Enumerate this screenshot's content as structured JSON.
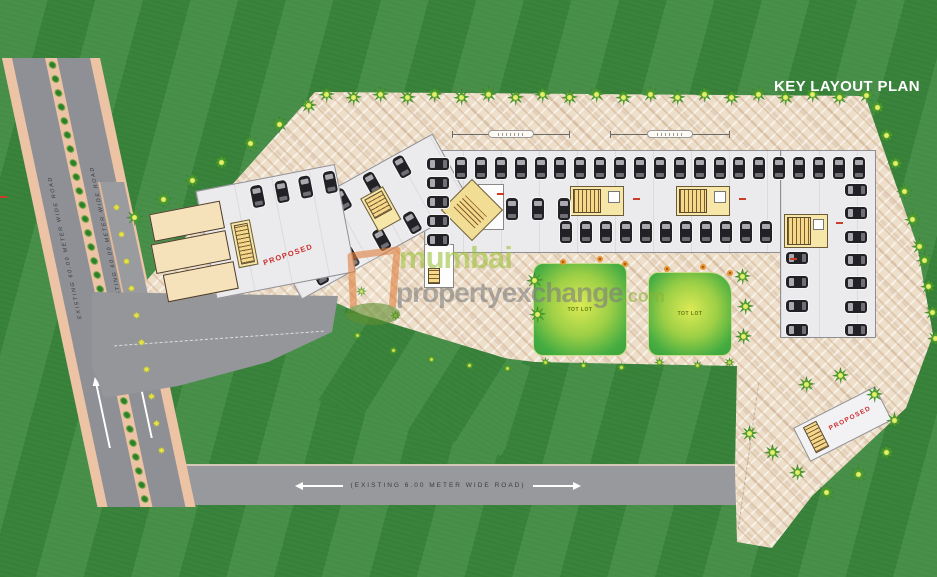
{
  "title": "KEY LAYOUT PLAN",
  "watermark": {
    "word1": "mumbai",
    "word2": "propertyexchange",
    "word3": ".com"
  },
  "roads": {
    "main_road_lane_outer": "EXISTING 60.00 METER WIDE ROAD",
    "main_road_lane_inner": "EXISTING 60.00 METER WIDE ROAD",
    "bottom_road": "(EXISTING 6.00 METER WIDE ROAD)"
  },
  "site": {
    "proposed_label": "PROPOSED",
    "lawn_label": "TOT LOT"
  },
  "colors": {
    "grass": "#3e8a40",
    "paver": "#eedfca",
    "asphalt": "#8f9095",
    "sidewalk": "#edc3a5",
    "slab": "#ebebee",
    "stair_yellow": "#f4d98a",
    "lawn_center": "#dcea54",
    "lawn_edge": "#3aa03c",
    "proposed_red": "#cd2a2a",
    "watermark_green": "#9cc23c",
    "watermark_gray": "#7d7d7d",
    "title": "#ffffff"
  }
}
